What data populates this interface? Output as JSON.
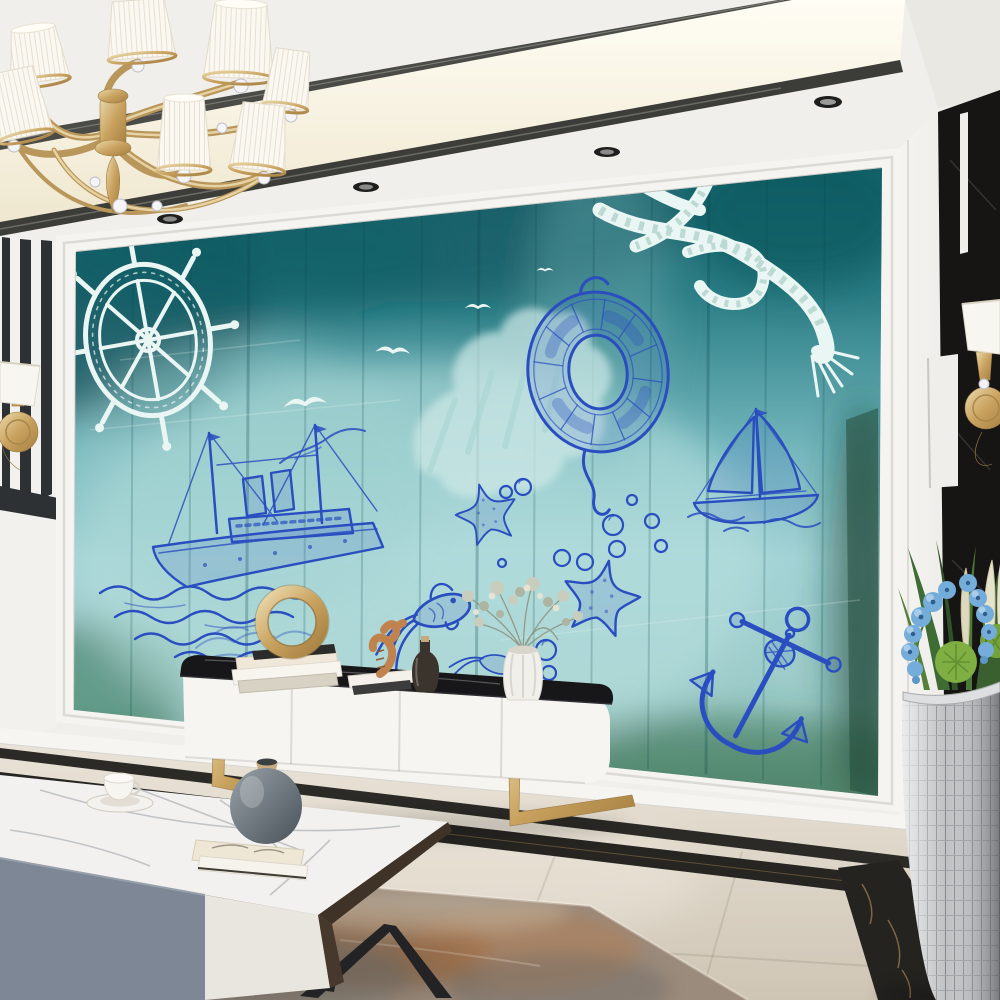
{
  "meta": {
    "title": "Living room with nautical teal wall mural",
    "kind": "interior photograph, no visible text"
  },
  "colors": {
    "ink-blue": "#2a4ec0",
    "sketch-white": "#e9f6f3",
    "mural-teal-deep": "#0e535c",
    "mural-teal": "#2a7d85",
    "mural-aqua": "#9ccfd4",
    "mural-green": "#2f6b4c",
    "gold": "#c9a25f",
    "gold-light": "#e7d6a8",
    "ceiling-white": "#f0efeb",
    "cove-warm": "#fdf9ea",
    "trim-dark": "#3c3c38",
    "wall-white": "#f4f3f0",
    "marble-black": "#161514",
    "floor-beige": "#d8d0c2",
    "strip-black": "#2b2a27",
    "rug-rust": "#b3643a",
    "rug-grey": "#7e7b74",
    "console-white": "#f6f5f2",
    "slab-black": "#17171a",
    "table-grey": "#7e8795",
    "table-cream": "#e9e6df",
    "wood-dark": "#46382c",
    "vase-grey": "#5f6a70",
    "orchid-blue": "#74add9",
    "leaf-green": "#3f6b34",
    "pot-silver": "#bfc1c3"
  },
  "ceiling": {
    "label": "white tray ceiling with warm lit cove and dark metal trim",
    "spotlight_count": 4
  },
  "chandelier": {
    "label": "gold chandelier with white pleated drum shades and crystal balls",
    "visible_shades": 7
  },
  "left_wall": {
    "label": "black and white striped marble pilaster panels"
  },
  "right_wall": {
    "label": "white wall with black marble geometric inlay panels"
  },
  "sconces": {
    "label": "gold wall sconces with white fabric shades",
    "count": 2
  },
  "wall_mural": {
    "label": "teal grunge wood-plank mural with nautical sketches",
    "white_motifs": [
      "ship-wheel",
      "seagulls",
      "rope-knot",
      "splash"
    ],
    "blue_motifs": [
      "steamship-with-waves",
      "lifebuoy",
      "sailboat",
      "anchor",
      "starfish",
      "goldfish",
      "bubbles"
    ]
  },
  "tv_console": {
    "label": "white media console with black marble top and gold sled legs",
    "decor": [
      "book-stack",
      "gold-ring-sculpture",
      "seahorse-figurine",
      "dark-bottle",
      "white-ribbed-vase-with-dried-bouquet"
    ]
  },
  "coffee_table": {
    "label": "white marble coffee table with grey and cream drawers and black angular legs",
    "decor": [
      "teacup-on-saucer",
      "art-books",
      "grey-round-vase"
    ]
  },
  "floor": {
    "label": "polished beige marble floor with double black marble border inlay"
  },
  "rug": {
    "label": "rust and grey abstract area rug"
  },
  "plant": {
    "label": "blue orchids, grasses and green pom plants in silver mosaic urn"
  }
}
